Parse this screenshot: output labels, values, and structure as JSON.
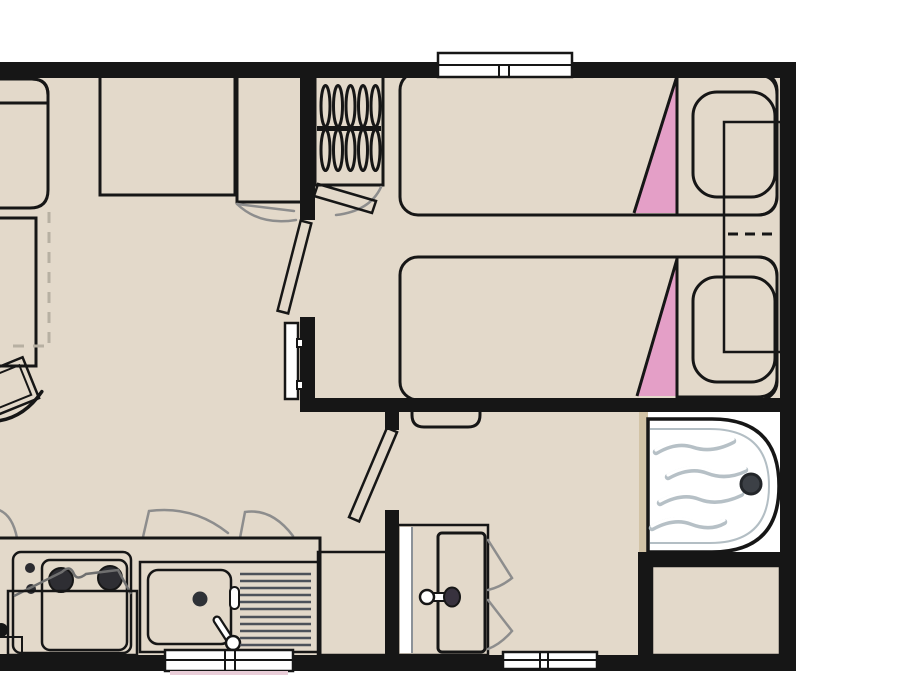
{
  "plan": {
    "type": "mobile-home-floorplan",
    "rooms": [
      {
        "name": "living-room-with-kitchen"
      },
      {
        "name": "twin-bedroom"
      },
      {
        "name": "bathroom"
      }
    ],
    "furniture": {
      "living_kitchen": [
        "dinette-bench",
        "dining-table-with-folding-extension",
        "chair",
        "wall-cabinet-large",
        "wall-cabinet-small",
        "wardrobe-with-hangers",
        "wall-heater",
        "kitchen-counter",
        "hob-two-burners",
        "open-oven-door",
        "sink-with-drainboard"
      ],
      "bedroom": [
        "twin-bed-1",
        "twin-bed-2",
        "pillow-1",
        "pillow-2",
        "folding-bedside-table",
        "interior-door"
      ],
      "bathroom": [
        "bathroom-door",
        "washbasin-vanity",
        "shower-tray-with-drain",
        "technical-cabinet",
        "entry-step"
      ]
    },
    "openings": [
      "window-top-bedroom",
      "window-bottom-kitchen",
      "window-bottom-bathroom",
      "door-living-to-bedroom",
      "door-bathroom",
      "wardrobe-door"
    ]
  },
  "colors": {
    "wall": "#161616",
    "floor": "#e3d9ca",
    "wood": "#c3b18c",
    "bed": "#ad3a75",
    "bed_linen": "#e49fc7",
    "pillow": "#a53270",
    "counter": "#6b5a6b",
    "nightstand": "#6e6070",
    "door_leaf": "#ffffff",
    "swing_arc": "#8d8d8d",
    "drain": "#3c4046",
    "window": "#ffffff",
    "basin_blue_top": "#d9edf6",
    "basin_blue_bottom": "#a9cbdd",
    "metal_light": "#fdfdfd",
    "metal_dark": "#878d96"
  }
}
